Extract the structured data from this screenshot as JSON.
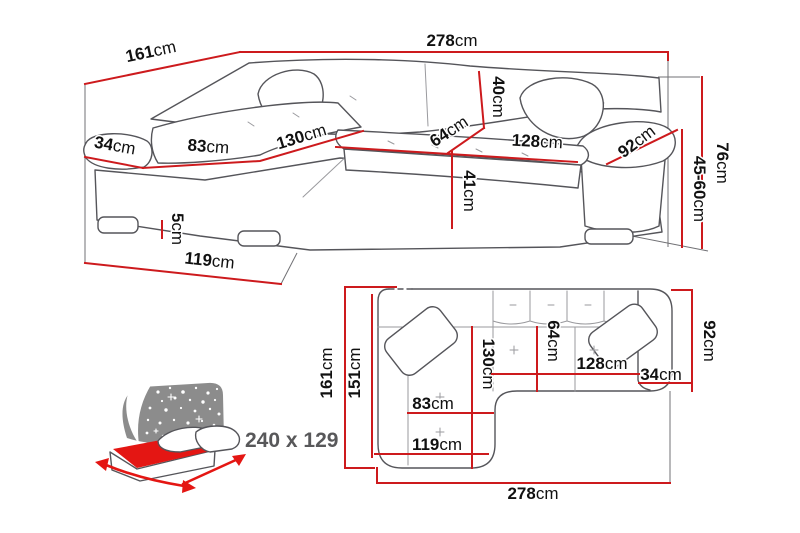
{
  "meta": {
    "description": "Corner sofa-bed dimension diagram with perspective view, top plan view and fold-out bed size icon"
  },
  "colors": {
    "dimension": "#cd1a1d",
    "mattress": "#e41613",
    "headboard": "#8c8c8c",
    "outline": "#55555a",
    "label": "#111111",
    "bed_text": "#58585a"
  },
  "persp": {
    "total_width": {
      "v": "278",
      "u": "cm"
    },
    "side_depth": {
      "v": "161",
      "u": "cm"
    },
    "left_arm_width": {
      "v": "34",
      "u": "cm"
    },
    "chaise_seat_width": {
      "v": "83",
      "u": "cm"
    },
    "chaise_seat_length": {
      "v": "130",
      "u": "cm"
    },
    "back_cushion_height": {
      "v": "40",
      "u": "cm"
    },
    "seat_depth": {
      "v": "64",
      "u": "cm"
    },
    "seat_width": {
      "v": "128",
      "u": "cm"
    },
    "right_arm_length": {
      "v": "92",
      "u": "cm"
    },
    "front_height": {
      "v": "41",
      "u": "cm"
    },
    "leg_height": {
      "v": "5",
      "u": "cm"
    },
    "chaise_outer_length": {
      "v": "119",
      "u": "cm"
    },
    "total_height": {
      "v": "76",
      "u": "cm"
    },
    "seat_height": {
      "v": "45-60",
      "u": "cm"
    }
  },
  "plan": {
    "side_depth": {
      "v": "161",
      "u": "cm"
    },
    "inner_depth": {
      "v": "151",
      "u": "cm"
    },
    "chaise_length": {
      "v": "130",
      "u": "cm"
    },
    "seat_depth": {
      "v": "64",
      "u": "cm"
    },
    "seat_width": {
      "v": "128",
      "u": "cm"
    },
    "right_arm_width": {
      "v": "34",
      "u": "cm"
    },
    "right_arm_length": {
      "v": "92",
      "u": "cm"
    },
    "chaise_seat_width": {
      "v": "83",
      "u": "cm"
    },
    "chaise_outer_length": {
      "v": "119",
      "u": "cm"
    },
    "total_width": {
      "v": "278",
      "u": "cm"
    }
  },
  "bed": {
    "sleeping_area": "240 x 129"
  }
}
